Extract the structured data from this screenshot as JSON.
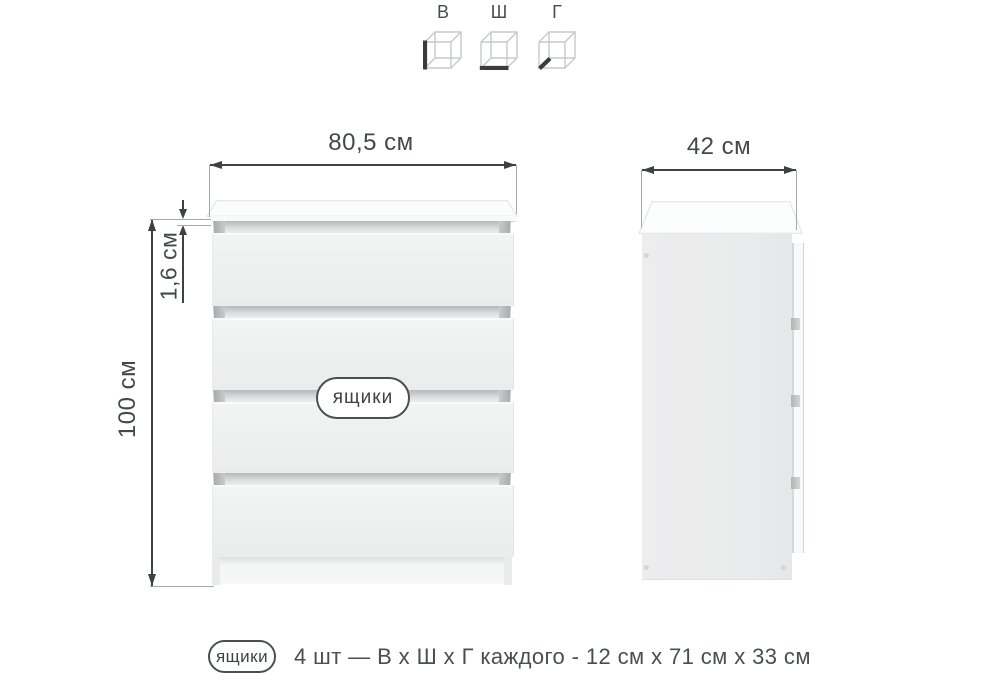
{
  "legend": {
    "height_letter": "В",
    "width_letter": "Ш",
    "depth_letter": "Г"
  },
  "front_view": {
    "width_label": "80,5 см",
    "height_label": "100 см",
    "top_thickness_label": "1,6 см",
    "drawers_badge": "ящики",
    "drawer_count": 4
  },
  "side_view": {
    "depth_label": "42 см"
  },
  "caption": {
    "badge": "ящики",
    "text": "4 шт — В х Ш х Г каждого - 12 см х 71 см х 33 см"
  },
  "colors": {
    "dimension": "#3e4245",
    "extension_line": "#a6a9ac",
    "panel_fill": "#eeefef",
    "slot_fill": "#b4b8bb",
    "background": "#ffffff"
  }
}
